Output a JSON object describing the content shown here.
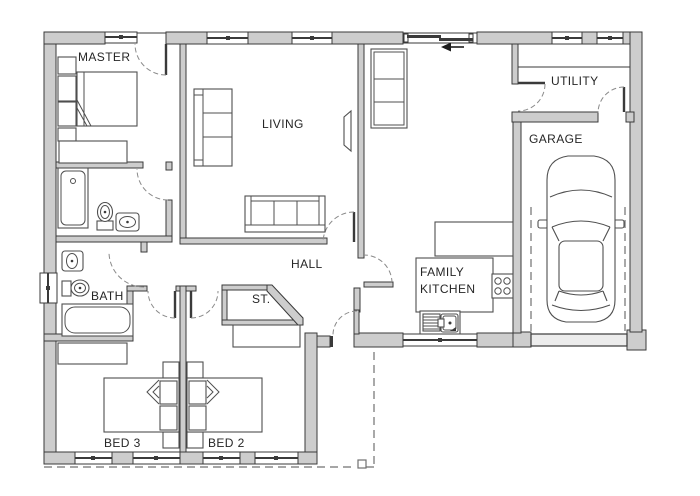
{
  "plan": {
    "type": "floor-plan",
    "rooms": {
      "master": "MASTER",
      "living": "LIVING",
      "utility": "UTILITY",
      "garage": "GARAGE",
      "hall": "HALL",
      "family_kitchen_line1": "FAMILY",
      "family_kitchen_line2": "KITCHEN",
      "bath": "BATH",
      "storage": "ST.",
      "bed3": "BED 3",
      "bed2": "BED 2"
    },
    "colors": {
      "background": "#ffffff",
      "wall_fill": "#cdcdcd",
      "wall_line": "#3a3a3a",
      "furniture_line": "#4f4f4f",
      "door_arc": "#8a8a8a",
      "boundary_dash": "#707070",
      "label_text": "#262626"
    }
  }
}
